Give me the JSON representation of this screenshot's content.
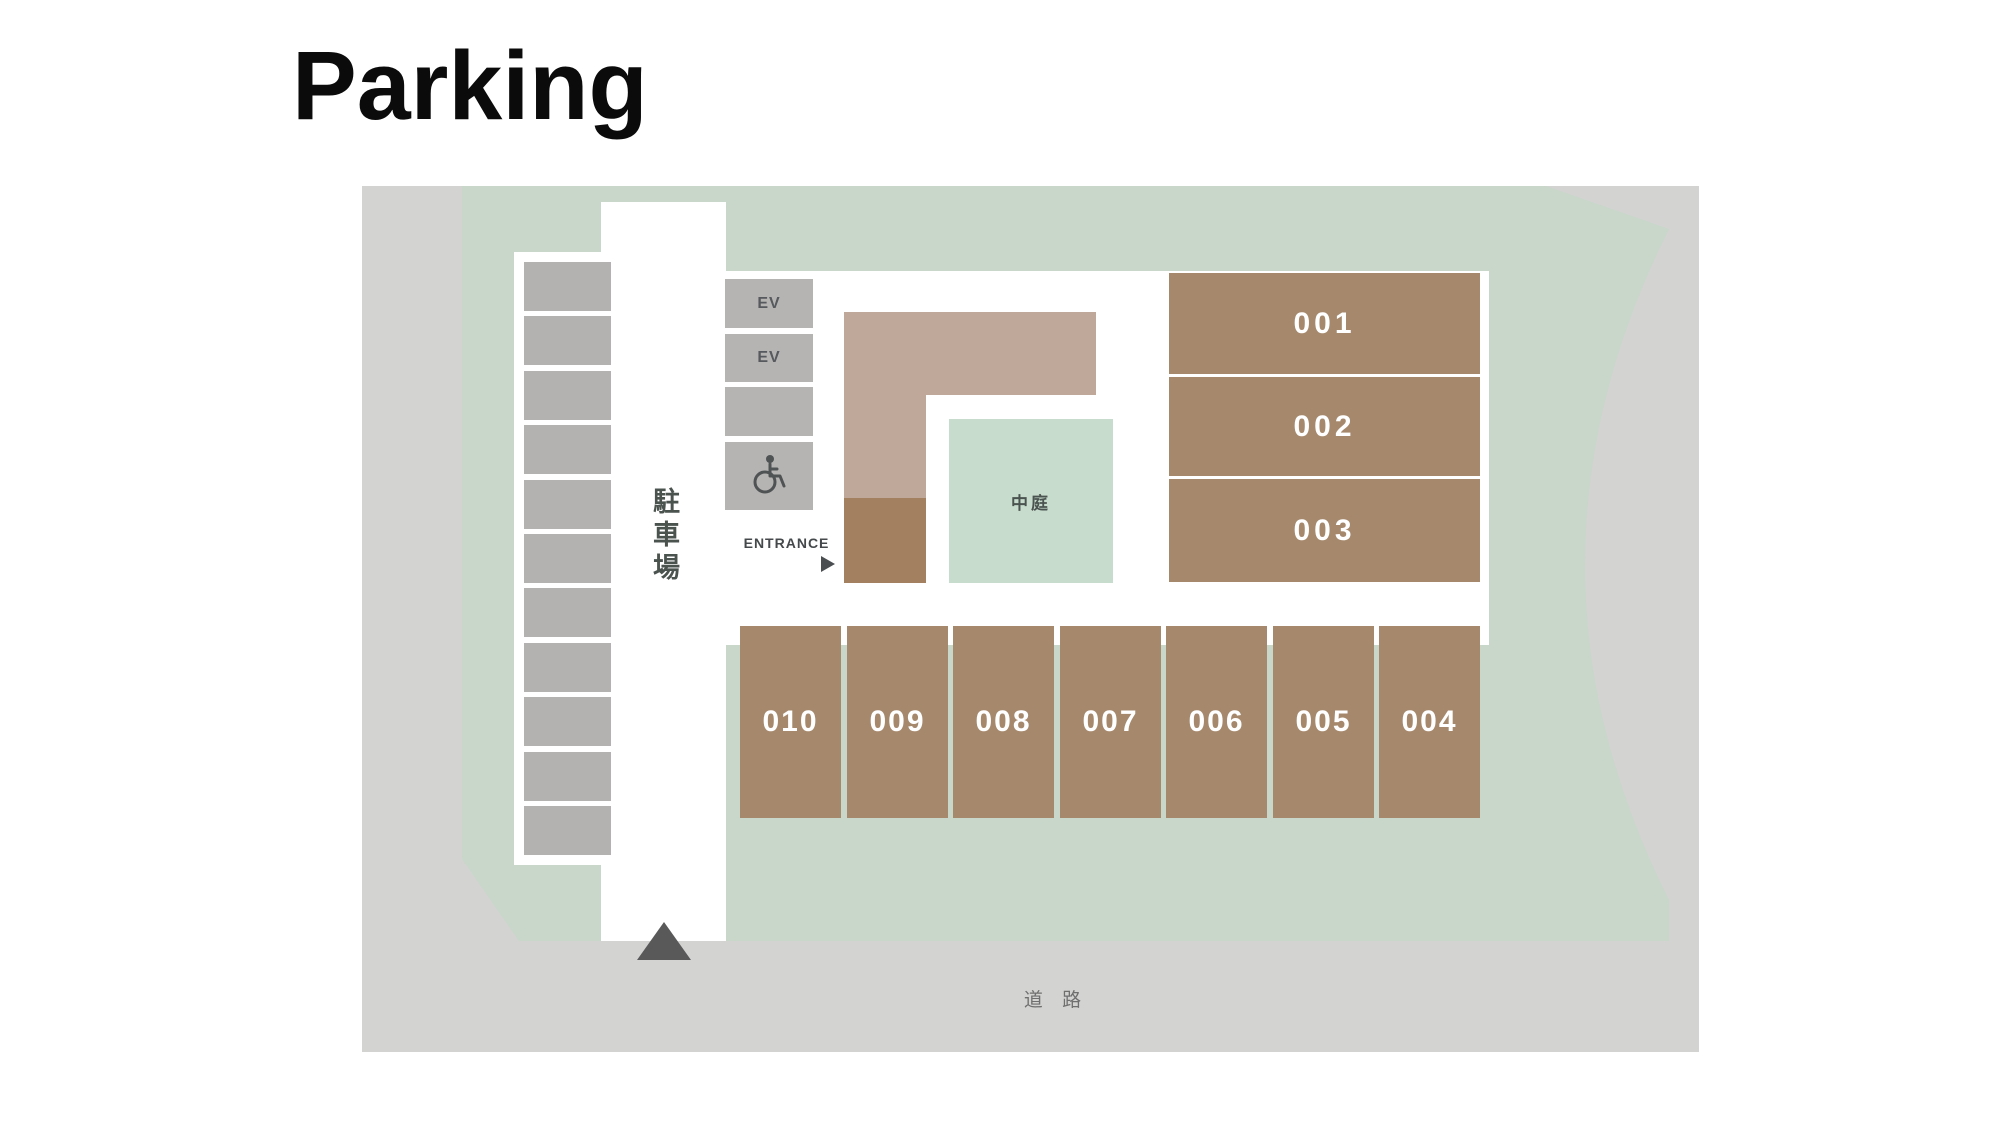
{
  "page": {
    "title": "Parking"
  },
  "map": {
    "parking_lot_label": "駐車場",
    "entrance_label": "ENTRANCE",
    "courtyard_label": "中庭",
    "road_label": "道 路",
    "side_stall_count": 11,
    "ev_units": [
      {
        "label": "EV"
      },
      {
        "label": "EV"
      },
      {
        "label": ""
      },
      {
        "label": "",
        "icon": "wheelchair-accessible"
      }
    ],
    "rooms": [
      {
        "label": "001"
      },
      {
        "label": "002"
      },
      {
        "label": "003"
      }
    ],
    "spaces_row": [
      {
        "label": "010"
      },
      {
        "label": "009"
      },
      {
        "label": "008"
      },
      {
        "label": "007"
      },
      {
        "label": "006"
      },
      {
        "label": "005"
      },
      {
        "label": "004"
      }
    ],
    "colors": {
      "road_gray": "#d3d3d2",
      "site_green": "#c8d7c9",
      "courtyard_green": "#c7dccd",
      "stall_gray": "#b3b2b1",
      "building_light_brown": "#bfa89a",
      "building_dark_brown": "#a3805f",
      "space_brown": "#a6896d",
      "label_white": "#ffffff",
      "text_dark": "#4b534f"
    }
  }
}
